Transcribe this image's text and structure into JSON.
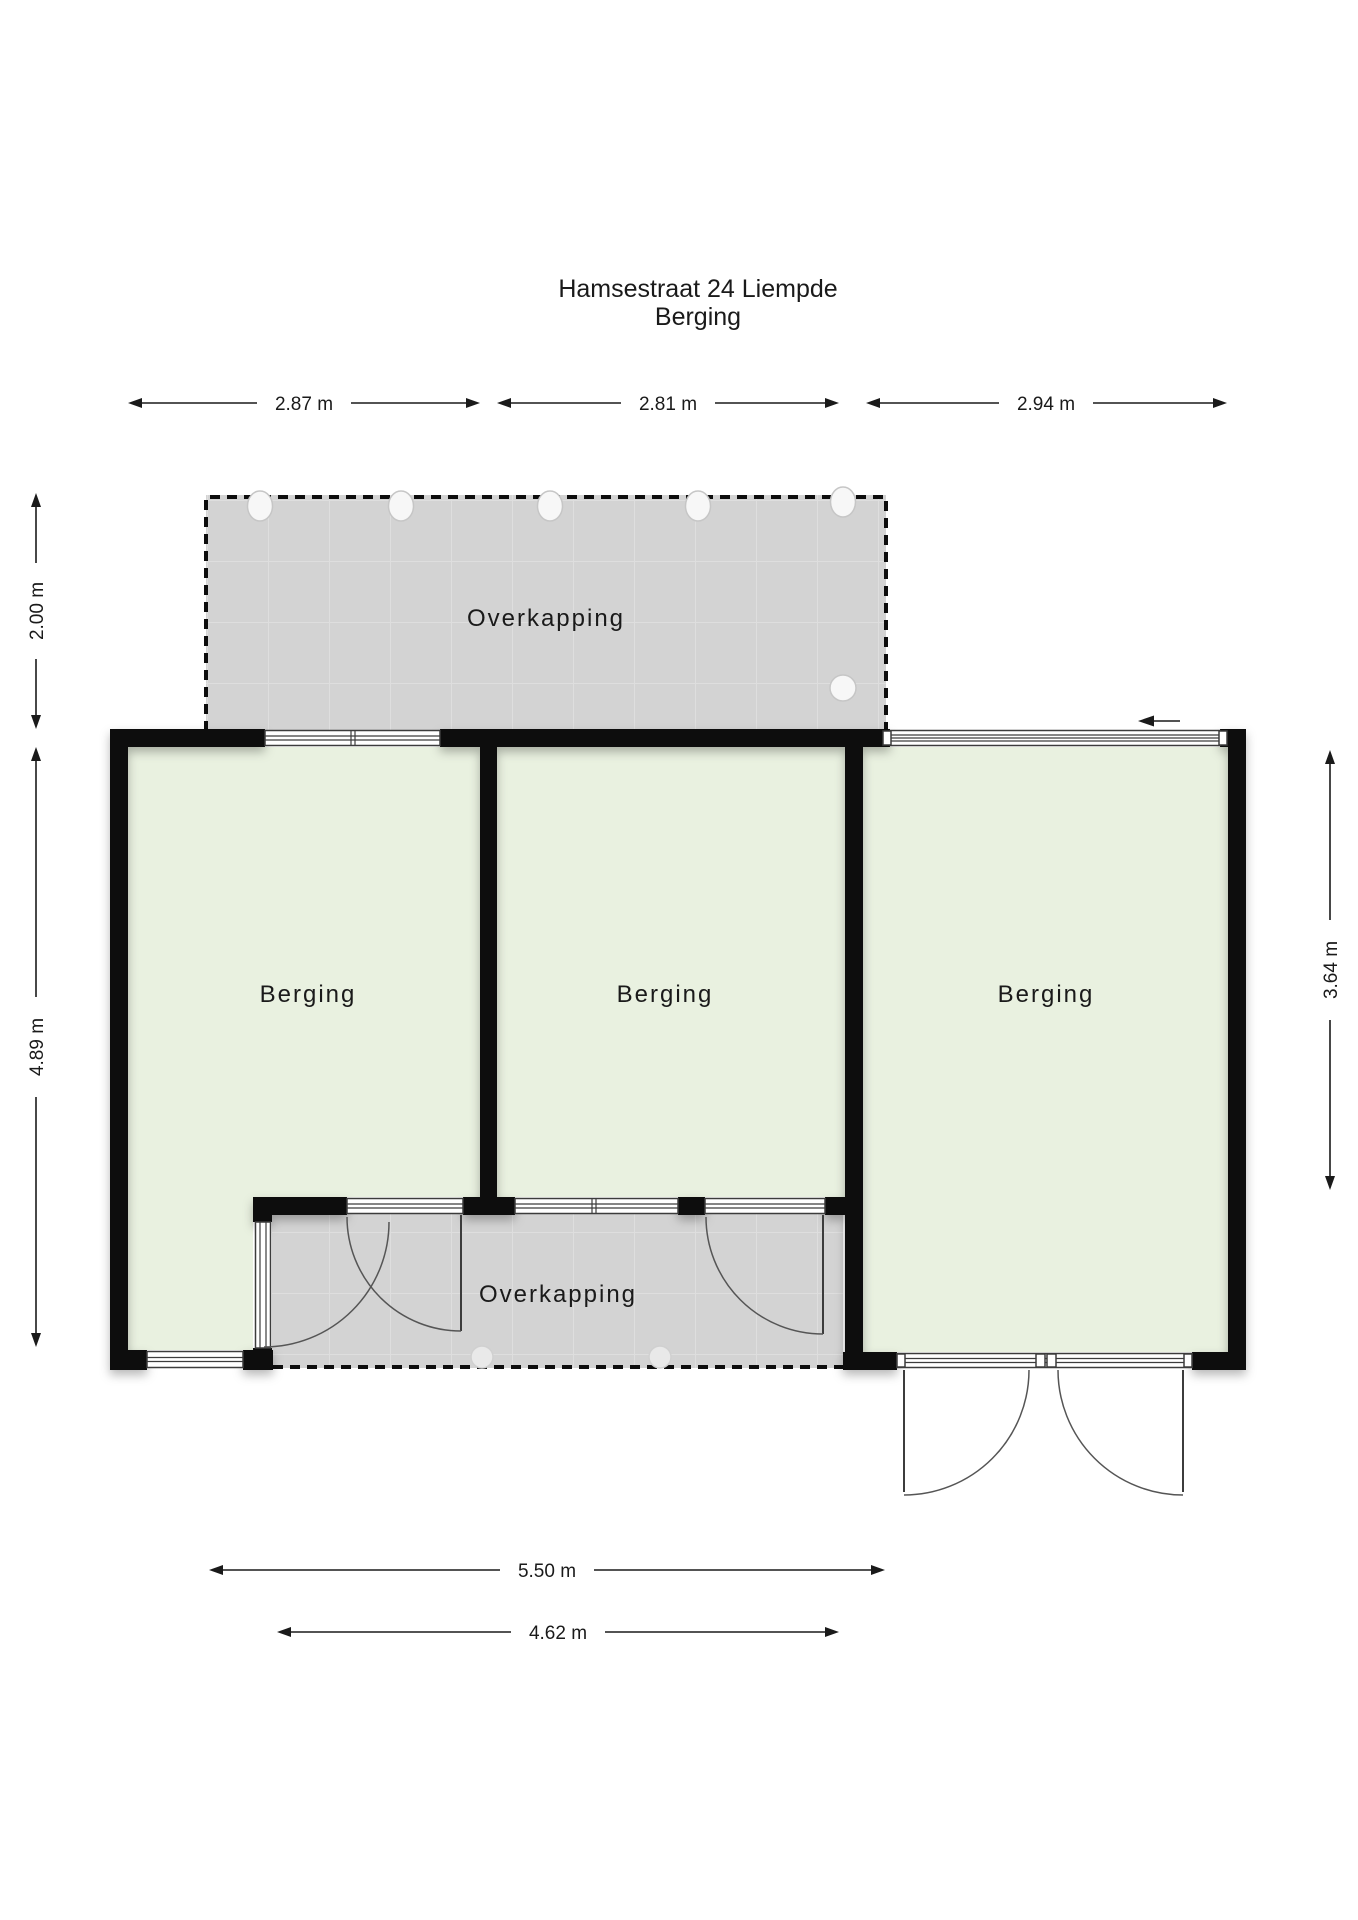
{
  "title": {
    "line1": "Hamsestraat 24 Liempde",
    "line2": "Berging"
  },
  "rooms": {
    "canopy_top": {
      "label": "Overkapping"
    },
    "berging_left": {
      "label": "Berging"
    },
    "berging_middle": {
      "label": "Berging"
    },
    "berging_right": {
      "label": "Berging"
    },
    "canopy_bottom": {
      "label": "Overkapping"
    }
  },
  "dimensions": {
    "top_left": "2.87 m",
    "top_middle": "2.81 m",
    "top_right": "2.94 m",
    "left_upper": "2.00 m",
    "left_lower": "4.89 m",
    "right_side": "3.64 m",
    "bottom_outer": "5.50 m",
    "bottom_inner": "4.62 m"
  },
  "colors": {
    "room_fill": "#e9f1e0",
    "canopy_fill": "#d3d3d3",
    "canopy_grid": "#dedede",
    "wall": "#0d0d0d",
    "text": "#1a1a1a",
    "symbol_line": "#3c3c3c"
  }
}
